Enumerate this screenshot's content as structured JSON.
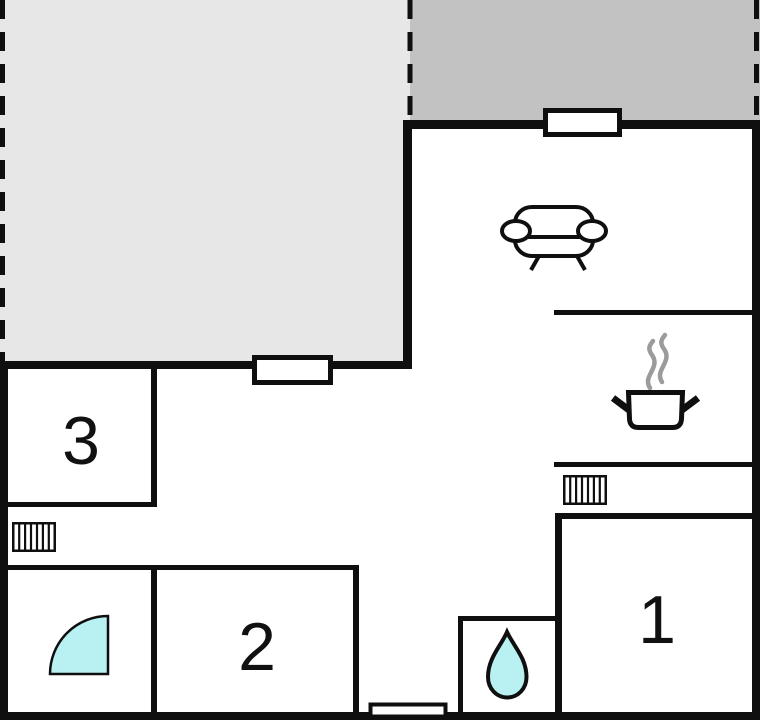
{
  "type": "floor-plan",
  "rooms": [
    {
      "name": "room-1",
      "label": "1"
    },
    {
      "name": "room-2",
      "label": "2"
    },
    {
      "name": "room-3",
      "label": "3"
    }
  ],
  "icons": {
    "sofa-icon": "inline-svg-shape",
    "steaming-pot-icon": "inline-svg-shape",
    "radiator-icon": "inline-svg-shape",
    "water-drop-icon": "inline-svg-shape",
    "shower-door-swing-icon": "inline-svg-shape",
    "window-marker": "inline-svg-shape",
    "entrance-step": "inline-svg-shape"
  },
  "colors": {
    "background": "#ffffff",
    "wall": "#0f0f0f",
    "terrace_light": "#e7e7e7",
    "terrace_dark": "#c2c2c2",
    "window": "#ffffff",
    "water": "#b9f1f2",
    "steam": "#9b9b9b",
    "label": "#111111"
  }
}
